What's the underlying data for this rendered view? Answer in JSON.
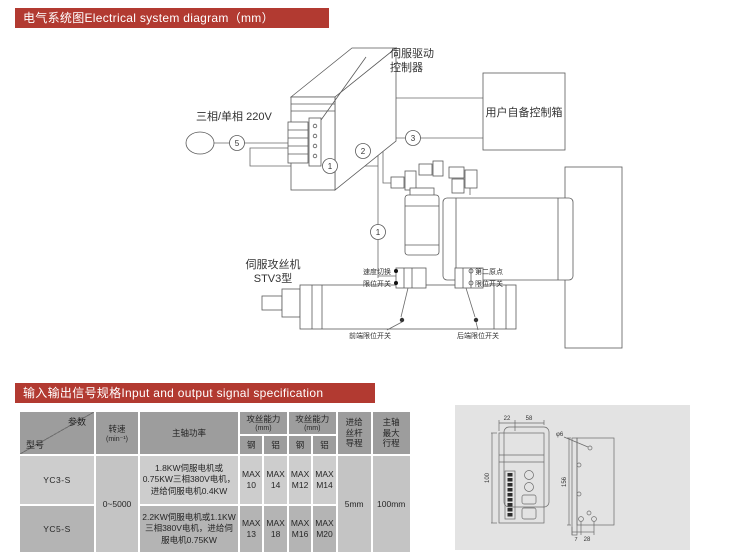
{
  "banners": {
    "accent_color": "#b23a31",
    "electrical": "电气系统图Electrical system diagram（mm）",
    "io": "输入输出信号规格Input and output signal specification"
  },
  "diagram": {
    "driver_line1": "伺服驱动",
    "driver_line2": "控制器",
    "power_label": "三相/单相 220V",
    "control_box_label": "用户自备控制箱",
    "machine_line1": "伺服攻丝机",
    "machine_line2": "STV3型",
    "callouts": {
      "c1": "1",
      "c1b": "1",
      "c2": "2",
      "c3": "3",
      "c5": "5"
    },
    "labels": {
      "speed_switch": "速度切换",
      "limit_switch_a": "限位开关",
      "second_origin": "第二原点",
      "limit_switch_b": "限位开关",
      "front_limit": "前端限位开关",
      "rear_limit": "后端限位开关"
    }
  },
  "spec_table": {
    "corner": {
      "top": "参数",
      "bottom": "型号"
    },
    "headers": {
      "speed": "转速",
      "speed_unit": "(min⁻¹)",
      "spindle_power": "主轴功率",
      "tap1": "攻丝能力",
      "tap1_unit": "(mm)",
      "tap2": "攻丝能力",
      "tap2_unit": "(mm)",
      "steel": "钢",
      "aluminum": "铝",
      "feed_lead": "进给\n丝杆\n导程",
      "max_stroke": "主轴\n最大\n行程"
    },
    "merged": {
      "speed_value": "0~5000",
      "feed_lead_value": "5mm",
      "max_stroke_value": "100mm"
    },
    "rows": [
      {
        "model": "YC3-S",
        "power": "1.8KW伺服电机或0.75KW三相380V电机，进给伺服电机0.4KW",
        "tap_steel1": "MAX\n10",
        "tap_alu1": "MAX\n14",
        "tap_steel2": "MAX\nM12",
        "tap_alu2": "MAX\nM14"
      },
      {
        "model": "YC5-S",
        "power": "2.2KW伺服电机或1.1KW三相380V电机，进给伺服电机0.75KW",
        "tap_steel1": "MAX\n13",
        "tap_alu1": "MAX\n18",
        "tap_steel2": "MAX\nM16",
        "tap_alu2": "MAX\nM20"
      }
    ]
  },
  "dimension_drawing": {
    "top_left": "22",
    "top_right": "58",
    "front_height": "100",
    "side_height": "156",
    "hole_dia": "φ6",
    "slot_offset": "7",
    "slot_pitch": "28"
  }
}
